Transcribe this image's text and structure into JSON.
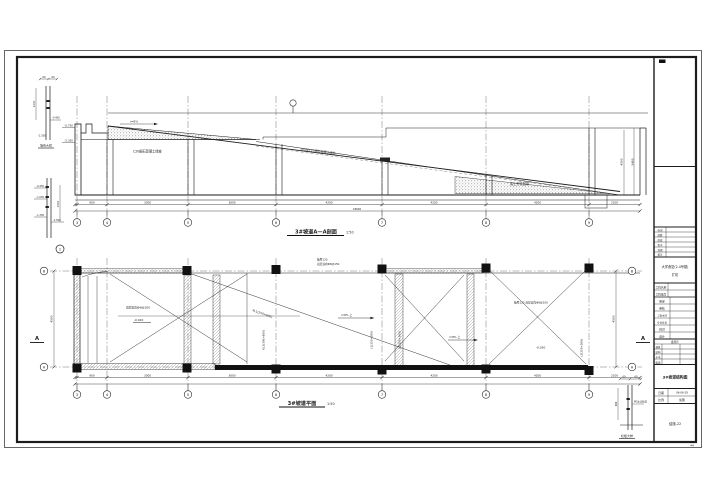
{
  "document": {
    "sheet_note": "44"
  },
  "section": {
    "caption": "3#坡道A—A剖面",
    "scale": "1:50",
    "slope_label": "i=8%",
    "surface_note": "100厚C25细石混凝土面层",
    "topping_note": "C20细石混凝土找坡",
    "fill_note": "素土夯实回填",
    "elev_top": "-0.750",
    "elev_bottom": "-2.350",
    "right_dim_inner": "4500",
    "right_dim_outer": "5400",
    "total_dim": "18600",
    "dims": [
      "900",
      "3300",
      "3600",
      "4200",
      "4200",
      "4200",
      "2100"
    ],
    "bubbles": [
      "3",
      "4",
      "5",
      "6",
      "7",
      "8",
      "9"
    ]
  },
  "plan": {
    "caption": "3#坡道平面",
    "scale": "1:50",
    "slab_note_line1": "板厚120",
    "slab_note_line2": "双层双向Φ8@150",
    "rebar_note": "双层双向Φ8@200",
    "slab_note_right": "板厚120 双层双向Φ8@200",
    "elev_a": "-0.020",
    "elev_b": "-0.050",
    "beam_diag_label": "XL1(250×600)",
    "beam_v1": "KL3(300×600)",
    "beam_v2": "L1(250×500)",
    "beam_v3": "L2(250×500)",
    "beam_v4": "L3(250×500)",
    "up_note_1": "i=8% 上",
    "up_note_2": "i=8% 上",
    "left_dim": "4500",
    "right_dim": "4500",
    "dims": [
      "900",
      "3300",
      "3600",
      "4200",
      "4200",
      "4200",
      "2100"
    ],
    "bubbles": [
      "3",
      "4",
      "5",
      "6",
      "7",
      "8",
      "9"
    ],
    "row_top": "B",
    "row_bottom": "A",
    "cut_label_left": "A",
    "cut_label_right": "A"
  },
  "details": {
    "d1": {
      "label": "墙身大样",
      "dim_a": "60",
      "dim_b": "60",
      "dim_left": "1200",
      "elev_a": "-0.450",
      "elev_b": "-2.350"
    },
    "d2": {
      "ref": "1",
      "elev_a": "-0.450",
      "elev_b": "-1.050",
      "elev_c": "-1.350",
      "dim_right": "1500",
      "elev_d": "-1.500"
    },
    "d3": {
      "label": "栏板大样",
      "dim_a": "60",
      "dim_b": "60",
      "dim_left": "900",
      "note": "M5水泥砂浆"
    }
  },
  "title_block": {
    "revision_rows": [
      "标记",
      "处数",
      "修改",
      "签字",
      "日期",
      "备注"
    ],
    "project_line1": "大学食堂(2-4号楼)",
    "project_line2": "扩初",
    "info_rows": [
      {
        "label": "工程名称"
      },
      {
        "label": "工程编号"
      }
    ],
    "staff_rows": [
      {
        "label": "审定"
      },
      {
        "label": "审核"
      },
      {
        "label": "工程主持"
      },
      {
        "label": "专业负责"
      },
      {
        "label": "校对"
      },
      {
        "label": "设计"
      }
    ],
    "sign_header": "会签栏",
    "sign_rows": [
      {
        "label": "建筑"
      },
      {
        "label": "结构"
      },
      {
        "label": "水电"
      },
      {
        "label": "暖通"
      }
    ],
    "drawing_title": "3#坡道结构图",
    "date_label": "日期",
    "date_value": "06-06-28",
    "scale_label": "比例",
    "scale_value": "如图",
    "sheet_label": "结施-22"
  }
}
